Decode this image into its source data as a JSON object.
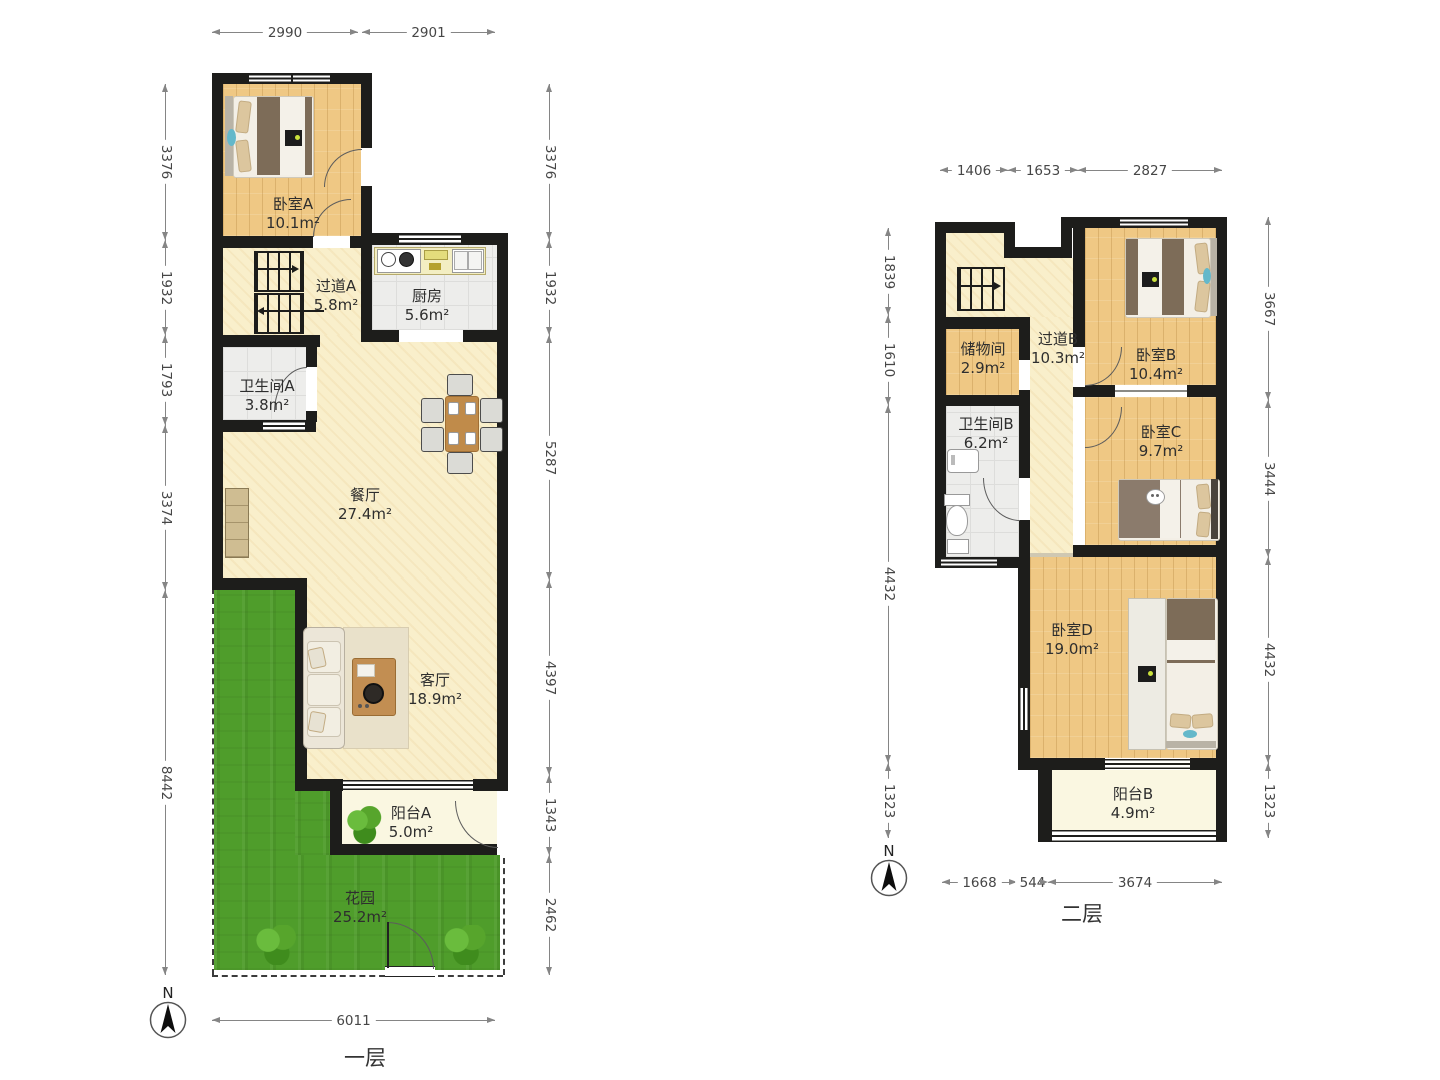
{
  "floor1": {
    "title": "一层",
    "rooms": {
      "bedroomA": {
        "name": "卧室A",
        "area": "10.1m²"
      },
      "hallwayA": {
        "name": "过道A",
        "area": "5.8m²"
      },
      "kitchen": {
        "name": "厨房",
        "area": "5.6m²"
      },
      "bathroomA": {
        "name": "卫生间A",
        "area": "3.8m²"
      },
      "dining": {
        "name": "餐厅",
        "area": "27.4m²"
      },
      "living": {
        "name": "客厅",
        "area": "18.9m²"
      },
      "balconyA": {
        "name": "阳台A",
        "area": "5.0m²"
      },
      "garden": {
        "name": "花园",
        "area": "25.2m²"
      }
    },
    "dims": {
      "top": [
        "2990",
        "2901"
      ],
      "left": [
        "3376",
        "1932",
        "1793",
        "3374",
        "8442"
      ],
      "right": [
        "3376",
        "1932",
        "5287",
        "4397",
        "1343",
        "2462"
      ],
      "bottom": [
        "6011"
      ]
    }
  },
  "floor2": {
    "title": "二层",
    "rooms": {
      "storage": {
        "name": "储物间",
        "area": "2.9m²"
      },
      "hallwayB": {
        "name": "过道B",
        "area": "10.3m²"
      },
      "bedroomB": {
        "name": "卧室B",
        "area": "10.4m²"
      },
      "bathroomB": {
        "name": "卫生间B",
        "area": "6.2m²"
      },
      "bedroomC": {
        "name": "卧室C",
        "area": "9.7m²"
      },
      "bedroomD": {
        "name": "卧室D",
        "area": "19.0m²"
      },
      "balconyB": {
        "name": "阳台B",
        "area": "4.9m²"
      }
    },
    "dims": {
      "top": [
        "1406",
        "1653",
        "2827"
      ],
      "left": [
        "1839",
        "1610",
        "4432",
        "1323"
      ],
      "right": [
        "3667",
        "3444",
        "4432",
        "1323"
      ],
      "bottom": [
        "1668",
        "544",
        "3674"
      ]
    }
  },
  "compass": {
    "n": "N"
  },
  "colors": {
    "wall": "#1d1d1b",
    "wood_floor": "#efc884",
    "cream_floor": "#f9efcb",
    "tile_floor": "#ededeb",
    "balcony_floor": "#faf7e1",
    "grass": "#4f9d2b",
    "blanket": "#7d6c58",
    "dim_text": "#464646"
  }
}
